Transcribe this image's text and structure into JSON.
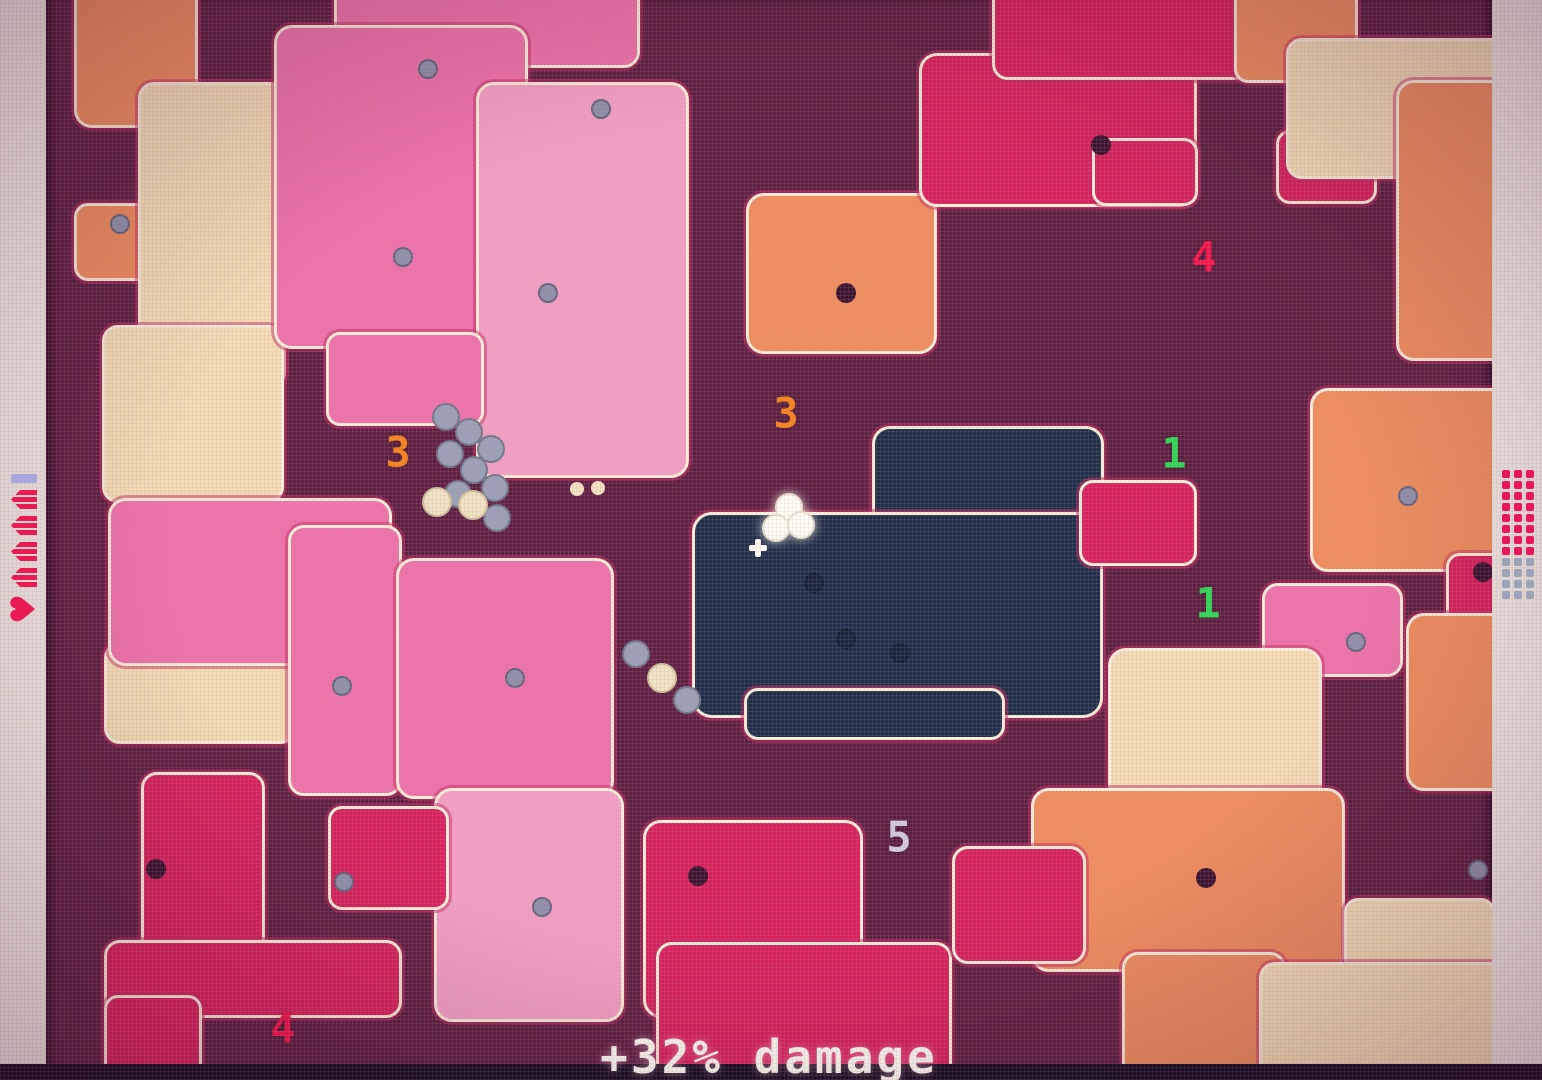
{
  "hud": {
    "bottom_text": "+32% damage",
    "left": {
      "bar_color": "#a8a6de",
      "charge_count": 4,
      "charge_color": "#ea1a52",
      "heart_glyph": "♥"
    },
    "right": {
      "dot_grid": {
        "cols": 3,
        "red_rows": 8,
        "gray_rows": 4,
        "red": "#e8175c",
        "gray": "#9aa3b8"
      }
    }
  },
  "palette": {
    "bg": "#5e2143",
    "pink": "#ee72aa",
    "lightpink": "#f29fc3",
    "crimson": "#d6235c",
    "salmon": "#ef8d5c",
    "tan": "#f3dcb4",
    "navy": "#20304a",
    "outline": "#f9eed9"
  },
  "map": {
    "blobs": [
      {
        "x": 28,
        "y": -20,
        "w": 118,
        "h": 142,
        "c": "salmon",
        "r": 18
      },
      {
        "x": 28,
        "y": 203,
        "w": 76,
        "h": 72,
        "c": "salmon",
        "r": 14
      },
      {
        "x": 92,
        "y": 82,
        "w": 142,
        "h": 300,
        "c": "tan",
        "r": 16
      },
      {
        "x": 56,
        "y": 325,
        "w": 176,
        "h": 172,
        "c": "tan",
        "r": 16
      },
      {
        "x": 58,
        "y": 642,
        "w": 186,
        "h": 96,
        "c": "tan",
        "r": 16
      },
      {
        "x": 288,
        "y": -18,
        "w": 300,
        "h": 80,
        "c": "pink",
        "r": 16
      },
      {
        "x": 228,
        "y": 25,
        "w": 248,
        "h": 318,
        "c": "pink",
        "r": 18
      },
      {
        "x": 430,
        "y": 82,
        "w": 207,
        "h": 390,
        "c": "lightpink",
        "r": 18
      },
      {
        "x": 280,
        "y": 332,
        "w": 152,
        "h": 88,
        "c": "pink",
        "r": 14
      },
      {
        "x": 62,
        "y": 498,
        "w": 278,
        "h": 162,
        "c": "pink",
        "r": 18
      },
      {
        "x": 242,
        "y": 525,
        "w": 108,
        "h": 265,
        "c": "pink",
        "r": 16
      },
      {
        "x": 350,
        "y": 558,
        "w": 212,
        "h": 235,
        "c": "pink",
        "r": 18
      },
      {
        "x": 388,
        "y": 788,
        "w": 184,
        "h": 228,
        "c": "lightpink",
        "r": 18
      },
      {
        "x": 95,
        "y": 772,
        "w": 118,
        "h": 185,
        "c": "crimson",
        "r": 16
      },
      {
        "x": 282,
        "y": 806,
        "w": 115,
        "h": 98,
        "c": "crimson",
        "r": 14
      },
      {
        "x": 58,
        "y": 940,
        "w": 292,
        "h": 72,
        "c": "crimson",
        "r": 16
      },
      {
        "x": 58,
        "y": 995,
        "w": 92,
        "h": 82,
        "c": "crimson",
        "r": 14
      },
      {
        "x": 597,
        "y": 820,
        "w": 214,
        "h": 192,
        "c": "crimson",
        "r": 18
      },
      {
        "x": 610,
        "y": 942,
        "w": 290,
        "h": 145,
        "c": "crimson",
        "r": 16
      },
      {
        "x": 700,
        "y": 193,
        "w": 185,
        "h": 155,
        "c": "salmon",
        "r": 18
      },
      {
        "x": 873,
        "y": 53,
        "w": 272,
        "h": 148,
        "c": "crimson",
        "r": 18
      },
      {
        "x": 946,
        "y": -18,
        "w": 252,
        "h": 92,
        "c": "crimson",
        "r": 16
      },
      {
        "x": 1046,
        "y": 138,
        "w": 100,
        "h": 62,
        "c": "crimson",
        "r": 14
      },
      {
        "x": 1230,
        "y": 130,
        "w": 95,
        "h": 68,
        "c": "crimson",
        "r": 14
      },
      {
        "x": 1188,
        "y": -18,
        "w": 118,
        "h": 95,
        "c": "salmon",
        "r": 14
      },
      {
        "x": 1240,
        "y": 38,
        "w": 225,
        "h": 135,
        "c": "tan",
        "r": 16
      },
      {
        "x": 1350,
        "y": 80,
        "w": 147,
        "h": 275,
        "c": "salmon",
        "r": 18
      },
      {
        "x": 826,
        "y": 426,
        "w": 226,
        "h": 135,
        "c": "navy",
        "r": 18
      },
      {
        "x": 646,
        "y": 512,
        "w": 405,
        "h": 200,
        "c": "navy",
        "r": 20
      },
      {
        "x": 698,
        "y": 688,
        "w": 255,
        "h": 46,
        "c": "navy",
        "r": 14
      },
      {
        "x": 1033,
        "y": 480,
        "w": 112,
        "h": 80,
        "c": "crimson",
        "r": 14
      },
      {
        "x": 1264,
        "y": 388,
        "w": 198,
        "h": 178,
        "c": "salmon",
        "r": 18
      },
      {
        "x": 1400,
        "y": 553,
        "w": 95,
        "h": 92,
        "c": "crimson",
        "r": 14
      },
      {
        "x": 1216,
        "y": 583,
        "w": 135,
        "h": 88,
        "c": "pink",
        "r": 16
      },
      {
        "x": 1360,
        "y": 613,
        "w": 135,
        "h": 172,
        "c": "salmon",
        "r": 18
      },
      {
        "x": 1062,
        "y": 648,
        "w": 208,
        "h": 148,
        "c": "tan",
        "r": 18
      },
      {
        "x": 985,
        "y": 788,
        "w": 308,
        "h": 178,
        "c": "salmon",
        "r": 18
      },
      {
        "x": 1076,
        "y": 952,
        "w": 158,
        "h": 135,
        "c": "salmon",
        "r": 16
      },
      {
        "x": 906,
        "y": 846,
        "w": 128,
        "h": 112,
        "c": "crimson",
        "r": 16
      },
      {
        "x": 1298,
        "y": 898,
        "w": 145,
        "h": 82,
        "c": "tan",
        "r": 14
      },
      {
        "x": 1213,
        "y": 962,
        "w": 285,
        "h": 125,
        "c": "tan",
        "r": 16
      }
    ],
    "numbers": [
      {
        "value": "3",
        "x": 352,
        "y": 452,
        "color": "#f5831e"
      },
      {
        "value": "3",
        "x": 740,
        "y": 413,
        "color": "#f5831e"
      },
      {
        "value": "4",
        "x": 1158,
        "y": 257,
        "color": "#f2164b"
      },
      {
        "value": "1",
        "x": 1128,
        "y": 453,
        "color": "#2ed654"
      },
      {
        "value": "1",
        "x": 1162,
        "y": 603,
        "color": "#2ed654"
      },
      {
        "value": "5",
        "x": 853,
        "y": 837,
        "color": "#cfcadf"
      },
      {
        "value": "4",
        "x": 237,
        "y": 1028,
        "color": "#f2164b"
      }
    ],
    "gray_dots": [
      {
        "x": 380,
        "y": 67
      },
      {
        "x": 553,
        "y": 107
      },
      {
        "x": 72,
        "y": 222
      },
      {
        "x": 355,
        "y": 255
      },
      {
        "x": 500,
        "y": 291
      },
      {
        "x": 294,
        "y": 684
      },
      {
        "x": 467,
        "y": 676
      },
      {
        "x": 296,
        "y": 880
      },
      {
        "x": 494,
        "y": 905
      },
      {
        "x": 1360,
        "y": 494
      },
      {
        "x": 1308,
        "y": 640
      },
      {
        "x": 1430,
        "y": 868
      }
    ],
    "dark_dots": [
      {
        "x": 1055,
        "y": 145
      },
      {
        "x": 800,
        "y": 293
      },
      {
        "x": 110,
        "y": 869
      },
      {
        "x": 652,
        "y": 876
      },
      {
        "x": 1160,
        "y": 878
      },
      {
        "x": 1437,
        "y": 572
      }
    ],
    "cream_dots": [
      {
        "x": 531,
        "y": 489
      },
      {
        "x": 552,
        "y": 488
      }
    ],
    "navy_bubbles": [
      {
        "x": 766,
        "y": 581
      },
      {
        "x": 798,
        "y": 637
      },
      {
        "x": 852,
        "y": 651
      }
    ],
    "enemies": [
      {
        "x": 398,
        "y": 415,
        "kind": "gray"
      },
      {
        "x": 421,
        "y": 430,
        "kind": "gray"
      },
      {
        "x": 443,
        "y": 447,
        "kind": "gray"
      },
      {
        "x": 402,
        "y": 452,
        "kind": "gray"
      },
      {
        "x": 426,
        "y": 468,
        "kind": "gray"
      },
      {
        "x": 447,
        "y": 486,
        "kind": "gray"
      },
      {
        "x": 410,
        "y": 492,
        "kind": "gray"
      },
      {
        "x": 449,
        "y": 516,
        "kind": "gray"
      },
      {
        "x": 389,
        "y": 500,
        "kind": "cream"
      },
      {
        "x": 425,
        "y": 503,
        "kind": "cream"
      },
      {
        "x": 588,
        "y": 652,
        "kind": "gray"
      },
      {
        "x": 614,
        "y": 676,
        "kind": "cream"
      },
      {
        "x": 639,
        "y": 698,
        "kind": "gray"
      }
    ],
    "player": {
      "blobs": [
        {
          "x": 741,
          "y": 505
        },
        {
          "x": 728,
          "y": 526
        },
        {
          "x": 753,
          "y": 523
        }
      ],
      "cross": {
        "x": 712,
        "y": 548
      }
    }
  }
}
